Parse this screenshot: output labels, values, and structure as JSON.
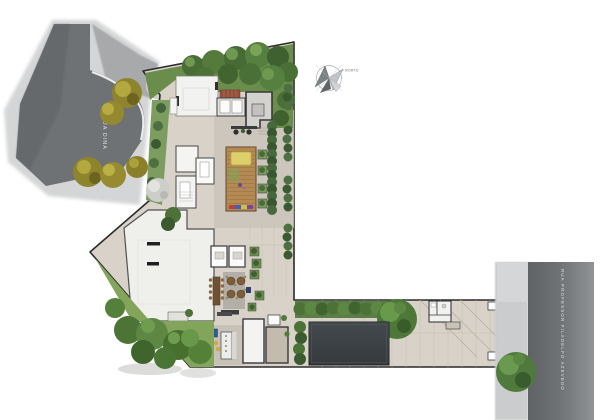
{
  "streets": {
    "left_label": "RUA DINA",
    "right_label": "RUA PROFESSOR FILADELFO AZEVEDO"
  },
  "compass": {
    "label": "NORTE"
  },
  "colors": {
    "road": "#6e7275",
    "road_right": "#6b6f72",
    "sidewalk": "#cbccce",
    "pavement": "#d8d2c8",
    "pavement_pool": "#cfc8bd",
    "pool": "#3c4145",
    "lawn": "#83a45b",
    "garden": "#6b8d4c",
    "deck": "#b48a52",
    "roof": "#f2f2f0",
    "tree_olive": "#8f842e",
    "tree_green": "#4e7838",
    "street_text": "#f2f2f2"
  }
}
